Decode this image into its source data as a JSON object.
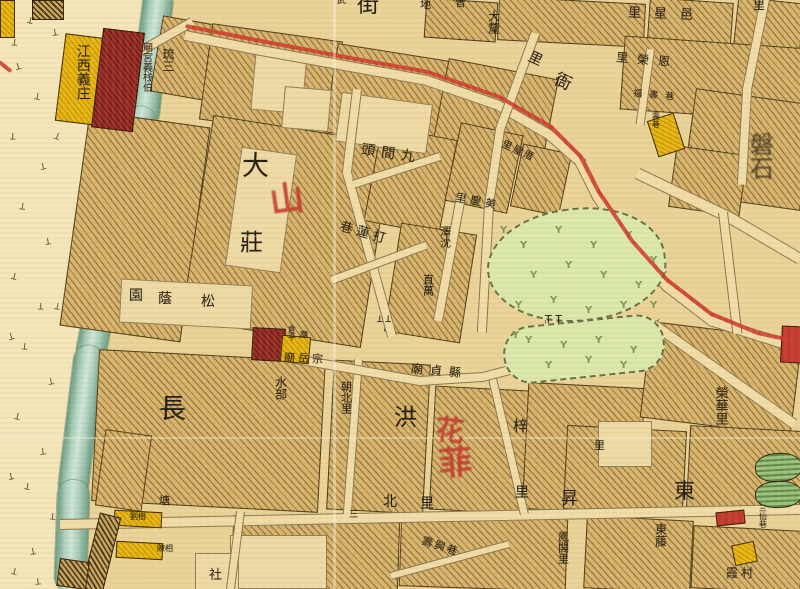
{
  "page": {
    "kind": "historical city map, hand-coloured, Chinese labels"
  },
  "palette": {
    "paper": "#ead398",
    "westbank": "#f4e6ba",
    "block_fill": "#d8b46c",
    "river": "#a5c9b6",
    "route_red": "#cf3a2c",
    "building_yellow": "#e9b70f",
    "building_darkred": "#9c2e26",
    "park_green": "#dbe8ab",
    "pond_green": "#9cc27c",
    "ink": "#241c10",
    "red_script": "#c43a2e"
  },
  "labels": [
    {
      "t": "街",
      "x": 357,
      "y": -6,
      "s": 22
    },
    {
      "t": "武",
      "x": 337,
      "y": -3,
      "s": 9
    },
    {
      "t": "地",
      "x": 420,
      "y": -1,
      "s": 11
    },
    {
      "t": "曾",
      "x": 455,
      "y": -3,
      "s": 11
    },
    {
      "t": "里",
      "x": 753,
      "y": -1,
      "s": 12
    },
    {
      "t": "大釐",
      "x": 487,
      "y": 10,
      "s": 12,
      "v": 1
    },
    {
      "t": "里",
      "x": 528,
      "y": 52,
      "s": 14,
      "r": 25
    },
    {
      "t": "衙",
      "x": 554,
      "y": 74,
      "s": 17,
      "r": 25
    },
    {
      "t": "里星邑",
      "x": 628,
      "y": 8,
      "s": 13,
      "ls": 13,
      "r": 2
    },
    {
      "t": "里榮恩",
      "x": 616,
      "y": 54,
      "s": 12,
      "ls": 9,
      "r": 5
    },
    {
      "t": "福書巷",
      "x": 633,
      "y": 92,
      "s": 9,
      "ls": 7,
      "r": 5
    },
    {
      "t": "壽巷",
      "x": 651,
      "y": 112,
      "s": 8,
      "v": 1
    },
    {
      "t": "磐石",
      "x": 740,
      "y": 132,
      "s": 24,
      "v": 1,
      "cls": "blur",
      "lh": 1.6
    },
    {
      "t": "江西義庄",
      "x": 74,
      "y": 44,
      "s": 14,
      "v": 1,
      "lh": 1.2
    },
    {
      "t": "琉三",
      "x": 159,
      "y": 48,
      "s": 12,
      "v": 1,
      "lh": 1.5
    },
    {
      "t": "廟宮義栈伯",
      "x": 140,
      "y": 42,
      "s": 10,
      "v": 1
    },
    {
      "t": "里屋厝",
      "x": 500,
      "y": 147,
      "s": 10,
      "ls": 2,
      "r": 25
    },
    {
      "t": "頭間九",
      "x": 361,
      "y": 147,
      "s": 14,
      "ls": 6,
      "r": 8
    },
    {
      "t": "大",
      "x": 242,
      "y": 153,
      "s": 27
    },
    {
      "t": "莊",
      "x": 240,
      "y": 231,
      "s": 23
    },
    {
      "t": "里慶美",
      "x": 455,
      "y": 196,
      "s": 11,
      "ls": 4,
      "r": 10
    },
    {
      "t": "澤沈",
      "x": 439,
      "y": 226,
      "s": 11,
      "v": 1
    },
    {
      "t": "巷蓮打",
      "x": 339,
      "y": 227,
      "s": 13,
      "ls": 4,
      "r": 16
    },
    {
      "t": "直萬",
      "x": 422,
      "y": 274,
      "s": 11,
      "v": 1
    },
    {
      "t": "園",
      "x": 129,
      "y": 289,
      "s": 14
    },
    {
      "t": "蔭",
      "x": 158,
      "y": 292,
      "s": 14
    },
    {
      "t": "松",
      "x": 201,
      "y": 295,
      "s": 14
    },
    {
      "t": "T T",
      "x": 545,
      "y": 314,
      "s": 11
    },
    {
      "t": "T T",
      "x": 377,
      "y": 312,
      "s": 9,
      "r": 180
    },
    {
      "t": "倉平",
      "x": 287,
      "y": 325,
      "s": 8,
      "v": 1
    },
    {
      "t": "廟",
      "x": 300,
      "y": 331,
      "s": 8
    },
    {
      "t": "廟岳宗",
      "x": 284,
      "y": 353,
      "s": 11,
      "ls": 3,
      "r": 3
    },
    {
      "t": "廟貞縣",
      "x": 411,
      "y": 365,
      "s": 12,
      "ls": 7,
      "r": 5
    },
    {
      "t": "水部",
      "x": 274,
      "y": 376,
      "s": 12,
      "v": 1
    },
    {
      "t": "朝北里",
      "x": 340,
      "y": 381,
      "s": 11,
      "v": 1
    },
    {
      "t": "榮華里",
      "x": 710,
      "y": 386,
      "s": 13,
      "v": 1,
      "lh": 1.5
    },
    {
      "t": "長",
      "x": 159,
      "y": 396,
      "s": 27
    },
    {
      "t": "洪",
      "x": 394,
      "y": 406,
      "s": 23
    },
    {
      "t": "梓",
      "x": 513,
      "y": 419,
      "s": 15
    },
    {
      "t": "里",
      "x": 594,
      "y": 440,
      "s": 11
    },
    {
      "t": "東",
      "x": 674,
      "y": 480,
      "s": 21
    },
    {
      "t": "里",
      "x": 515,
      "y": 486,
      "s": 14
    },
    {
      "t": "昇",
      "x": 561,
      "y": 491,
      "s": 17
    },
    {
      "t": "北",
      "x": 383,
      "y": 495,
      "s": 14
    },
    {
      "t": "里",
      "x": 420,
      "y": 497,
      "s": 14
    },
    {
      "t": "塘",
      "x": 159,
      "y": 495,
      "s": 11
    },
    {
      "t": "三",
      "x": 349,
      "y": 511,
      "s": 9
    },
    {
      "t": "三仙巷",
      "x": 758,
      "y": 504,
      "s": 8,
      "v": 1
    },
    {
      "t": "劉樹",
      "x": 130,
      "y": 513,
      "s": 8
    },
    {
      "t": "東藤",
      "x": 654,
      "y": 523,
      "s": 12,
      "v": 1
    },
    {
      "t": "鳳閣里",
      "x": 557,
      "y": 531,
      "s": 11,
      "v": 1
    },
    {
      "t": "壽興巷",
      "x": 421,
      "y": 541,
      "s": 11,
      "ls": 2,
      "r": 18
    },
    {
      "t": "陳相",
      "x": 157,
      "y": 545,
      "s": 8
    },
    {
      "t": "霞村",
      "x": 726,
      "y": 567,
      "s": 12,
      "ls": 3
    },
    {
      "t": "社",
      "x": 209,
      "y": 569,
      "s": 13
    }
  ],
  "red_marks": [
    {
      "t": "山",
      "x": 270,
      "y": 183,
      "s": 34,
      "r": -8
    },
    {
      "t": "花",
      "x": 436,
      "y": 416,
      "s": 28,
      "r": 6
    },
    {
      "t": "菲",
      "x": 439,
      "y": 446,
      "s": 33,
      "r": -4
    }
  ],
  "blocks": [
    [
      156,
      20,
      58,
      75,
      10
    ],
    [
      205,
      32,
      130,
      95,
      8
    ],
    [
      330,
      52,
      118,
      88,
      9
    ],
    [
      440,
      68,
      110,
      80,
      11
    ],
    [
      425,
      0,
      70,
      38,
      4
    ],
    [
      498,
      0,
      145,
      42,
      3
    ],
    [
      648,
      0,
      82,
      52,
      4
    ],
    [
      735,
      0,
      65,
      58,
      6
    ],
    [
      622,
      42,
      185,
      72,
      4
    ],
    [
      688,
      96,
      118,
      105,
      8
    ],
    [
      74,
      118,
      120,
      215,
      8
    ],
    [
      196,
      128,
      180,
      205,
      9
    ],
    [
      372,
      132,
      75,
      95,
      11
    ],
    [
      392,
      228,
      75,
      108,
      9
    ],
    [
      452,
      128,
      62,
      78,
      12
    ],
    [
      516,
      148,
      48,
      62,
      12
    ],
    [
      672,
      150,
      70,
      60,
      8
    ],
    [
      95,
      355,
      225,
      150,
      3
    ],
    [
      330,
      362,
      95,
      148,
      3
    ],
    [
      432,
      388,
      92,
      122,
      3
    ],
    [
      525,
      385,
      115,
      125,
      3
    ],
    [
      645,
      330,
      150,
      95,
      7
    ],
    [
      565,
      428,
      118,
      82,
      3
    ],
    [
      688,
      428,
      112,
      80,
      3
    ],
    [
      585,
      518,
      105,
      71,
      3
    ],
    [
      692,
      528,
      108,
      61,
      3
    ],
    [
      232,
      518,
      165,
      71,
      2
    ],
    [
      400,
      515,
      165,
      72,
      2
    ],
    [
      100,
      432,
      45,
      75,
      8
    ]
  ],
  "cream_patches": [
    [
      253,
      52,
      50,
      58,
      5
    ],
    [
      283,
      88,
      45,
      40,
      5
    ],
    [
      338,
      98,
      90,
      48,
      8
    ],
    [
      233,
      150,
      54,
      118,
      8
    ],
    [
      120,
      282,
      130,
      42,
      3
    ],
    [
      545,
      316,
      42,
      58,
      0
    ],
    [
      598,
      421,
      52,
      44,
      0
    ],
    [
      230,
      535,
      95,
      52,
      0
    ],
    [
      195,
      553,
      42,
      36,
      0
    ]
  ],
  "lanes": [
    [
      186,
      30,
      256,
      44,
      9
    ],
    [
      256,
      44,
      345,
      60,
      9
    ],
    [
      345,
      60,
      428,
      75,
      9
    ],
    [
      428,
      75,
      500,
      100,
      9
    ],
    [
      500,
      100,
      552,
      130,
      9
    ],
    [
      552,
      130,
      584,
      158,
      9
    ],
    [
      584,
      158,
      602,
      194,
      9
    ],
    [
      602,
      194,
      636,
      244,
      9
    ],
    [
      636,
      244,
      670,
      282,
      9
    ],
    [
      670,
      282,
      714,
      316,
      9
    ],
    [
      714,
      316,
      790,
      340,
      9
    ],
    [
      540,
      35,
      505,
      130,
      8
    ],
    [
      505,
      130,
      494,
      205,
      8
    ],
    [
      494,
      205,
      487,
      330,
      8
    ],
    [
      362,
      90,
      352,
      172,
      8
    ],
    [
      352,
      172,
      374,
      252,
      8
    ],
    [
      374,
      252,
      396,
      332,
      8
    ],
    [
      330,
      276,
      422,
      242,
      7
    ],
    [
      433,
      320,
      456,
      196,
      8
    ],
    [
      352,
      180,
      436,
      153,
      7
    ],
    [
      60,
      519,
      400,
      512,
      9
    ],
    [
      400,
      512,
      800,
      504,
      9
    ],
    [
      363,
      360,
      352,
      512,
      7
    ],
    [
      497,
      378,
      528,
      510,
      7
    ],
    [
      285,
      352,
      420,
      376,
      8
    ],
    [
      420,
      376,
      482,
      372,
      8
    ],
    [
      482,
      372,
      560,
      352,
      8
    ],
    [
      560,
      352,
      657,
      320,
      8
    ],
    [
      657,
      320,
      795,
      418,
      9
    ],
    [
      640,
      168,
      732,
      212,
      10
    ],
    [
      732,
      212,
      800,
      252,
      10
    ],
    [
      728,
      212,
      742,
      330,
      8
    ],
    [
      770,
      0,
      752,
      90,
      8
    ],
    [
      752,
      90,
      747,
      182,
      8
    ],
    [
      655,
      50,
      645,
      122,
      7
    ],
    [
      390,
      572,
      505,
      541,
      6
    ],
    [
      245,
      512,
      235,
      589,
      7
    ],
    [
      195,
      26,
      142,
      56,
      8
    ]
  ],
  "red_route": [
    [
      0,
      60,
      10,
      68
    ],
    [
      186,
      24,
      256,
      38
    ],
    [
      256,
      38,
      345,
      55
    ],
    [
      345,
      55,
      428,
      70
    ],
    [
      428,
      70,
      500,
      95
    ],
    [
      500,
      95,
      552,
      125
    ],
    [
      552,
      125,
      582,
      155
    ],
    [
      582,
      155,
      600,
      190
    ],
    [
      600,
      190,
      634,
      240
    ],
    [
      634,
      240,
      668,
      278
    ],
    [
      668,
      278,
      712,
      312
    ],
    [
      712,
      312,
      758,
      331
    ],
    [
      758,
      331,
      790,
      338
    ]
  ],
  "buildings": [
    {
      "x": 0,
      "y": 0,
      "w": 13,
      "h": 36,
      "rot": 0,
      "type": "yellow"
    },
    {
      "x": 32,
      "y": 0,
      "w": 30,
      "h": 18,
      "rot": 0,
      "type": "dark"
    },
    {
      "x": 60,
      "y": 36,
      "w": 48,
      "h": 86,
      "rot": 7,
      "type": "yellow"
    },
    {
      "x": 97,
      "y": 30,
      "w": 40,
      "h": 98,
      "rot": 7,
      "type": "darkred"
    },
    {
      "x": 652,
      "y": 116,
      "w": 26,
      "h": 36,
      "rot": -18,
      "type": "yellow"
    },
    {
      "x": 252,
      "y": 328,
      "w": 31,
      "h": 31,
      "rot": 3,
      "type": "darkred"
    },
    {
      "x": 281,
      "y": 336,
      "w": 27,
      "h": 25,
      "rot": 5,
      "type": "yellow"
    },
    {
      "x": 114,
      "y": 511,
      "w": 46,
      "h": 14,
      "rot": 3,
      "type": "yellow"
    },
    {
      "x": 116,
      "y": 542,
      "w": 45,
      "h": 15,
      "rot": 3,
      "type": "yellow"
    },
    {
      "x": 733,
      "y": 543,
      "w": 21,
      "h": 19,
      "rot": -12,
      "type": "yellow"
    },
    {
      "x": 781,
      "y": 326,
      "w": 19,
      "h": 35,
      "rot": 3,
      "type": "red"
    },
    {
      "x": 716,
      "y": 511,
      "w": 27,
      "h": 12,
      "rot": -6,
      "type": "red"
    },
    {
      "x": 755,
      "y": 453,
      "w": 45,
      "h": 27,
      "rot": -3,
      "type": "pond"
    },
    {
      "x": 755,
      "y": 481,
      "w": 45,
      "h": 25,
      "rot": -2,
      "type": "pond"
    },
    {
      "x": 90,
      "y": 514,
      "w": 20,
      "h": 78,
      "rot": 14,
      "type": "dark"
    },
    {
      "x": 58,
      "y": 560,
      "w": 28,
      "h": 26,
      "rot": 8,
      "type": "dark"
    }
  ],
  "marsh_marks": [
    [
      28,
      14,
      15
    ],
    [
      52,
      26,
      -10
    ],
    [
      12,
      36,
      5
    ],
    [
      15,
      60,
      -15
    ],
    [
      35,
      90,
      10
    ],
    [
      10,
      130,
      0
    ],
    [
      55,
      130,
      20
    ],
    [
      40,
      160,
      -12
    ],
    [
      20,
      200,
      8
    ],
    [
      45,
      235,
      -8
    ],
    [
      12,
      270,
      15
    ],
    [
      38,
      300,
      0
    ],
    [
      8,
      330,
      -18
    ],
    [
      55,
      300,
      12
    ],
    [
      22,
      340,
      6
    ],
    [
      48,
      375,
      -10
    ],
    [
      15,
      410,
      14
    ],
    [
      40,
      445,
      -6
    ],
    [
      25,
      480,
      10
    ],
    [
      8,
      470,
      -14
    ],
    [
      50,
      510,
      4
    ],
    [
      30,
      545,
      -10
    ],
    [
      12,
      565,
      12
    ],
    [
      35,
      575,
      -5
    ]
  ],
  "park_trees": [
    [
      500,
      225
    ],
    [
      520,
      240
    ],
    [
      555,
      225
    ],
    [
      590,
      240
    ],
    [
      625,
      230
    ],
    [
      650,
      255
    ],
    [
      530,
      270
    ],
    [
      565,
      260
    ],
    [
      600,
      270
    ],
    [
      635,
      280
    ],
    [
      660,
      270
    ],
    [
      515,
      300
    ],
    [
      550,
      295
    ],
    [
      585,
      305
    ],
    [
      620,
      300
    ],
    [
      650,
      300
    ],
    [
      512,
      330
    ],
    [
      525,
      335
    ],
    [
      560,
      340
    ],
    [
      595,
      335
    ],
    [
      630,
      345
    ],
    [
      545,
      360
    ],
    [
      585,
      355
    ],
    [
      620,
      360
    ]
  ]
}
